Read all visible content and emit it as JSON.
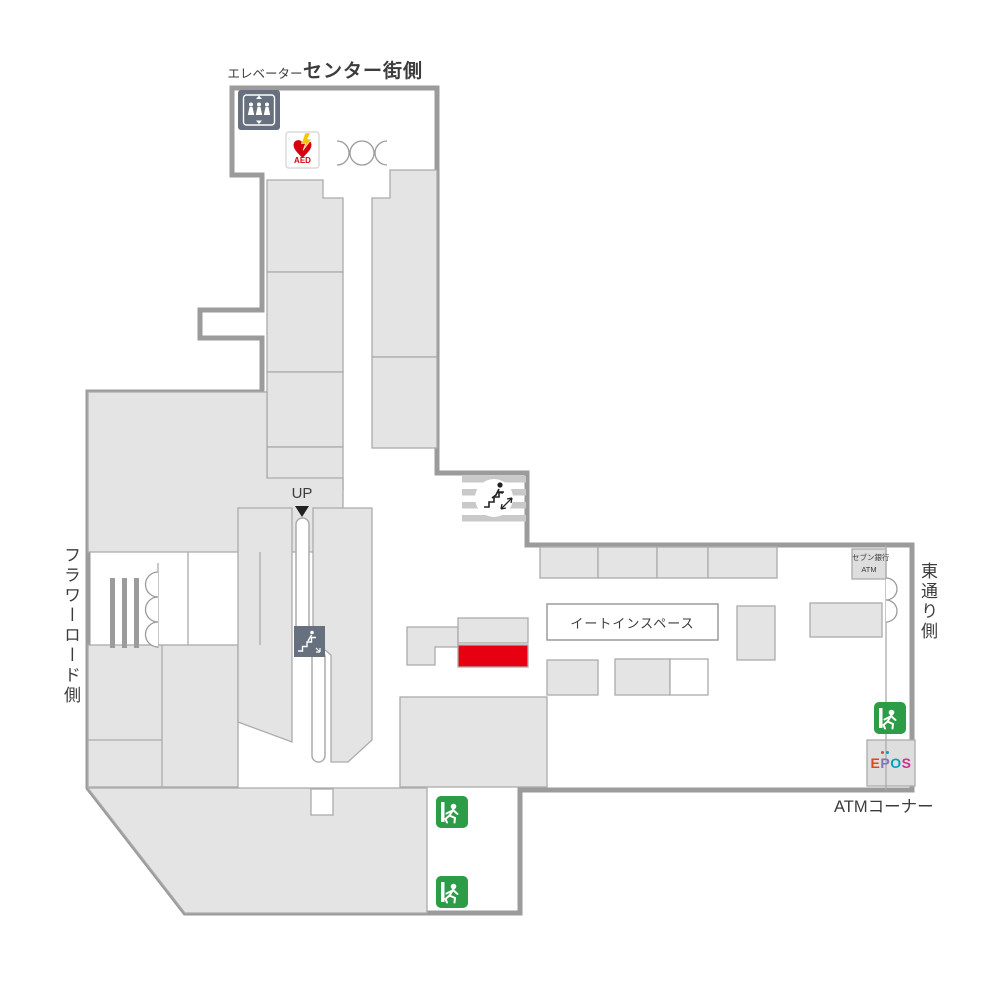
{
  "labels": {
    "elevator": "エレベーター",
    "center_gai_side": "センター街側",
    "flower_road_side": "フラワーロード側",
    "east_street_side": "東通り側",
    "up": "UP",
    "eat_in_space": "イートインスペース",
    "seven_bank": "セブン銀行",
    "seven_bank_atm": "ATM",
    "atm_corner": "ATMコーナー",
    "aed": "AED"
  },
  "epos": {
    "letters": [
      {
        "char": "E",
        "color": "#e8431c"
      },
      {
        "char": "P",
        "color": "#8077b8",
        "dots": [
          "#e8431c",
          "#00a0c0"
        ]
      },
      {
        "char": "O",
        "color": "#00a0c0"
      },
      {
        "char": "S",
        "color": "#cf2f8f"
      }
    ]
  },
  "colors": {
    "highlight": "#e60012",
    "exit_green": "#2d9c47",
    "icon_bg": "#66707e",
    "aed_red": "#d7000f",
    "aed_yellow": "#f2c50f",
    "wall": "#9b9b9b",
    "shop_fill": "#e4e4e4"
  },
  "icons": {
    "elevator": "elevator-icon",
    "aed": "aed-icon",
    "stairs": "stairs-icon",
    "escalator": "escalator-icon",
    "emergency_exit": "emergency-exit-icon",
    "door_swing": "door-swing-icon",
    "up_arrow": "up-arrow-icon"
  }
}
